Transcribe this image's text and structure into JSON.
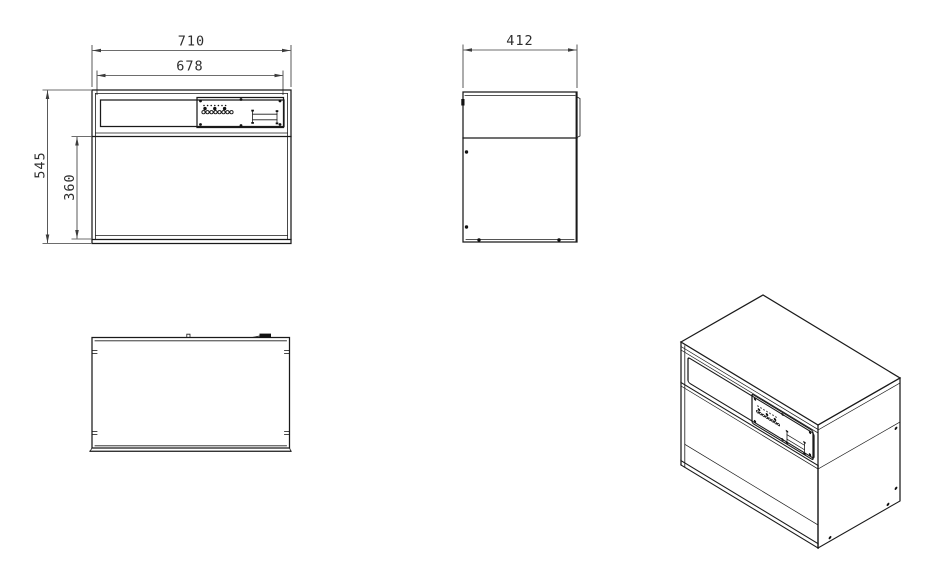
{
  "sheet": {
    "background_color": "#ffffff",
    "line_color": "#1a1a1a",
    "dim_color": "#3c3c3c"
  },
  "dimensions": {
    "front_outer_width": "710",
    "front_inner_width": "678",
    "total_height": "545",
    "opening_height": "360",
    "side_depth": "412"
  }
}
